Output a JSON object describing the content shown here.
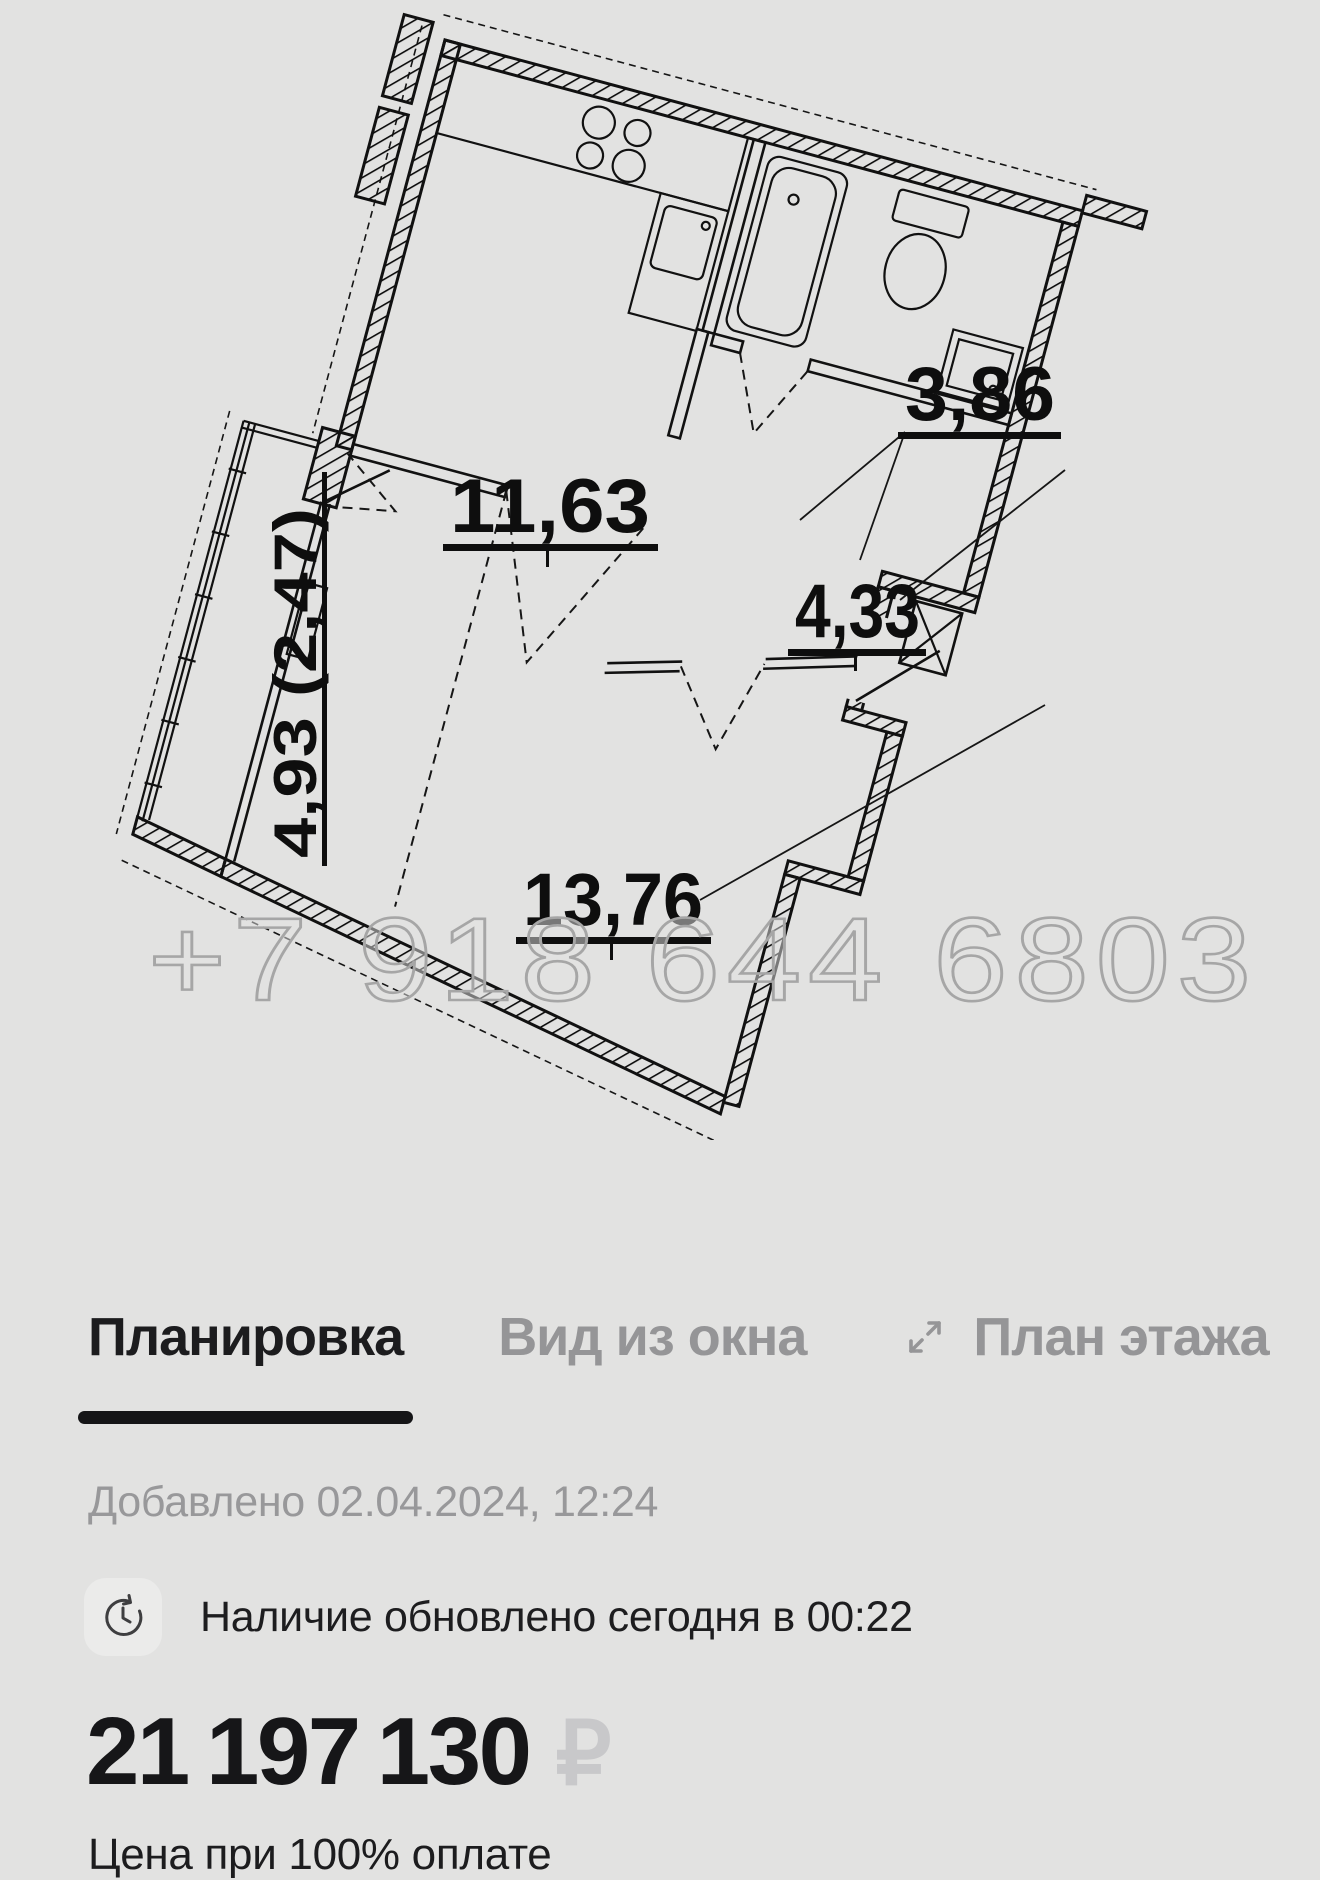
{
  "plan": {
    "watermark": "+7 918 644 6803",
    "rooms": [
      {
        "id": "kitchen-living",
        "area": "11,63"
      },
      {
        "id": "bathroom",
        "area": "3,86"
      },
      {
        "id": "hallway",
        "area": "4,33"
      },
      {
        "id": "room",
        "area": "13,76"
      },
      {
        "id": "balcony",
        "area": "4,93 (2,47)"
      }
    ]
  },
  "tabs": [
    {
      "label": "Планировка",
      "active": true
    },
    {
      "label": "Вид из окна",
      "active": false
    },
    {
      "label": "План этажа",
      "active": false,
      "icon": "expand-icon"
    }
  ],
  "listing": {
    "added": "Добавлено 02.04.2024, 12:24",
    "availability": "Наличие обновлено сегодня в 00:22",
    "price": "21 197 130",
    "currency": "₽",
    "price_note": "Цена при 100% оплате"
  },
  "colors": {
    "background": "#e2e2e1",
    "ink": "#111111",
    "active_tab": "#1c1c1e",
    "inactive_tab": "#959597",
    "muted_text": "#98989a",
    "price_currency": "#c8c8ca",
    "watermark": "#a6a6a6"
  }
}
